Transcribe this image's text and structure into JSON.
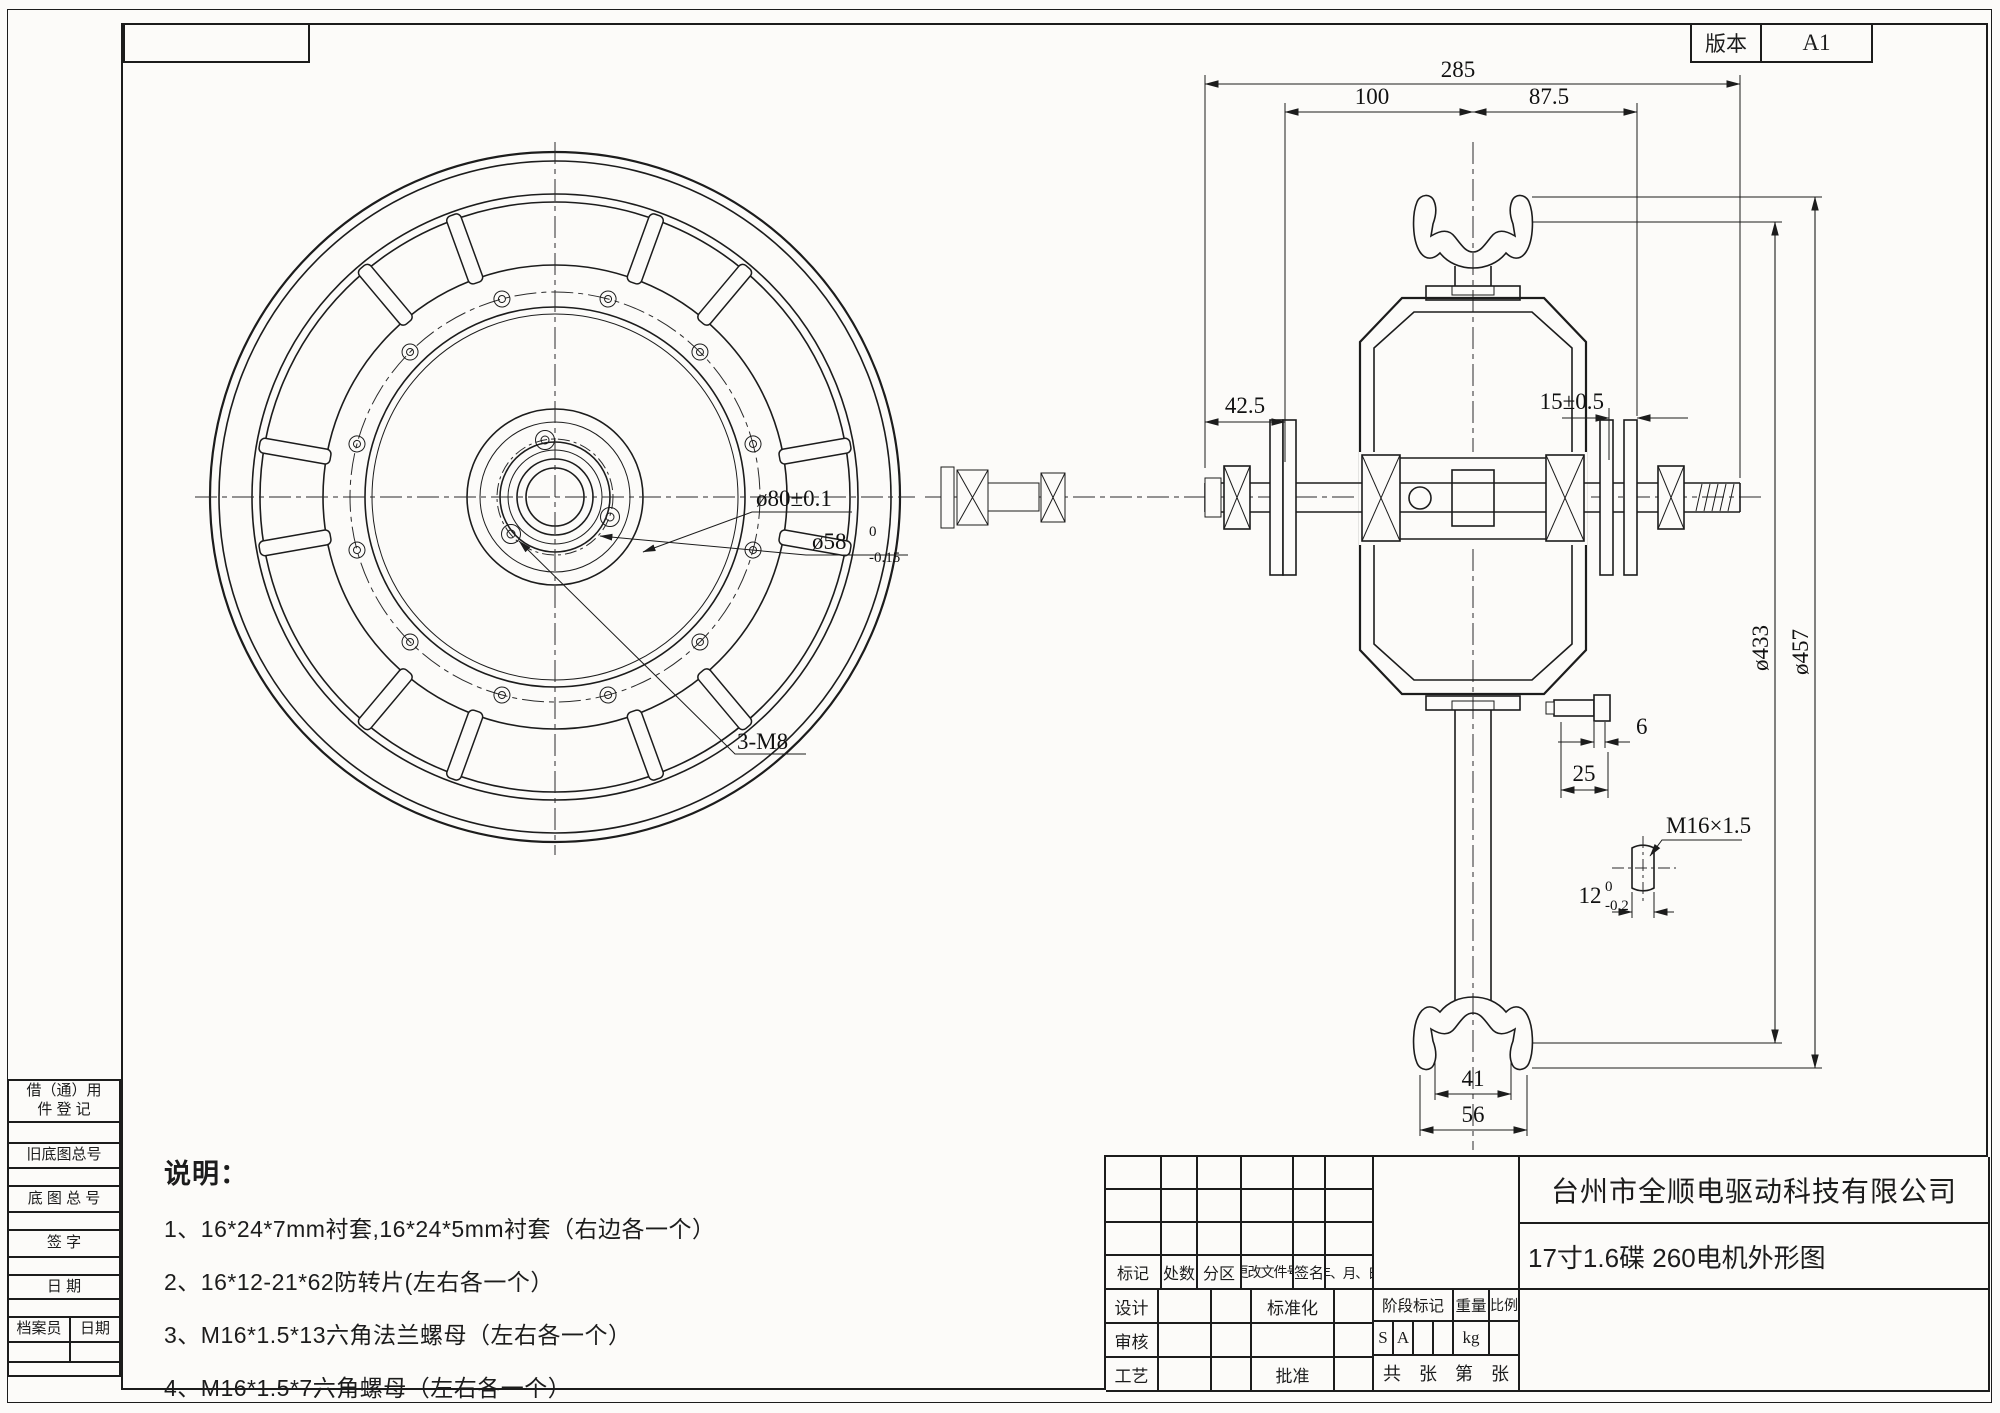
{
  "version_block": {
    "label": "版本",
    "value": "A1"
  },
  "left_panel": {
    "borrow_line1": "借（通）用",
    "borrow_line2": "件 登 记",
    "old_base_no": "旧底图总号",
    "base_no": "底 图 总 号",
    "sign": "签  字",
    "date": "日  期",
    "archivist": "档案员",
    "archive_date": "日期"
  },
  "notes": {
    "title": "说明：",
    "item1": "1、16*24*7mm衬套,16*24*5mm衬套（右边各一个）",
    "item2": "2、16*12-21*62防转片(左右各一个）",
    "item3": "3、M16*1.5*13六角法兰螺母（左右各一个）",
    "item4": "4、M16*1.5*7六角螺母（左右各一个）"
  },
  "title_block": {
    "company": "台州市全顺电驱动科技有限公司",
    "drawing_title": "17寸1.6碟 260电机外形图",
    "rev_headers": [
      "标记",
      "处数",
      "分区",
      "更改文件号",
      "签名",
      "年、月、日"
    ],
    "design": "设计",
    "standardize": "标准化",
    "review": "审核",
    "process": "工艺",
    "approve": "批准",
    "stage_mark": "阶段标记",
    "weight": "重量",
    "scale": "比例",
    "stage_s": "S",
    "stage_a": "A",
    "weight_unit": "kg",
    "total": "共",
    "sheet1": "张",
    "no": "第",
    "sheet2": "张"
  },
  "dims": {
    "overall": "285",
    "left_span": "100",
    "right_span": "87.5",
    "axle_left": "42.5",
    "disc_gap": "15±0.5",
    "dia_stator": "ø433",
    "dia_rim": "ø457",
    "bolt_len": "6",
    "flange_off": "25",
    "thread_spec": "M16×1.5",
    "flat_w": "12",
    "flat_tol_up": "0",
    "flat_tol_dn": "-0.2",
    "rim_inner": "41",
    "rim_outer": "56",
    "hub_dia": "ø80±0.1",
    "spigot_dia": "ø58",
    "spigot_tol_up": "0",
    "spigot_tol_dn": "-0.15",
    "hub_bolts": "3-M8"
  }
}
